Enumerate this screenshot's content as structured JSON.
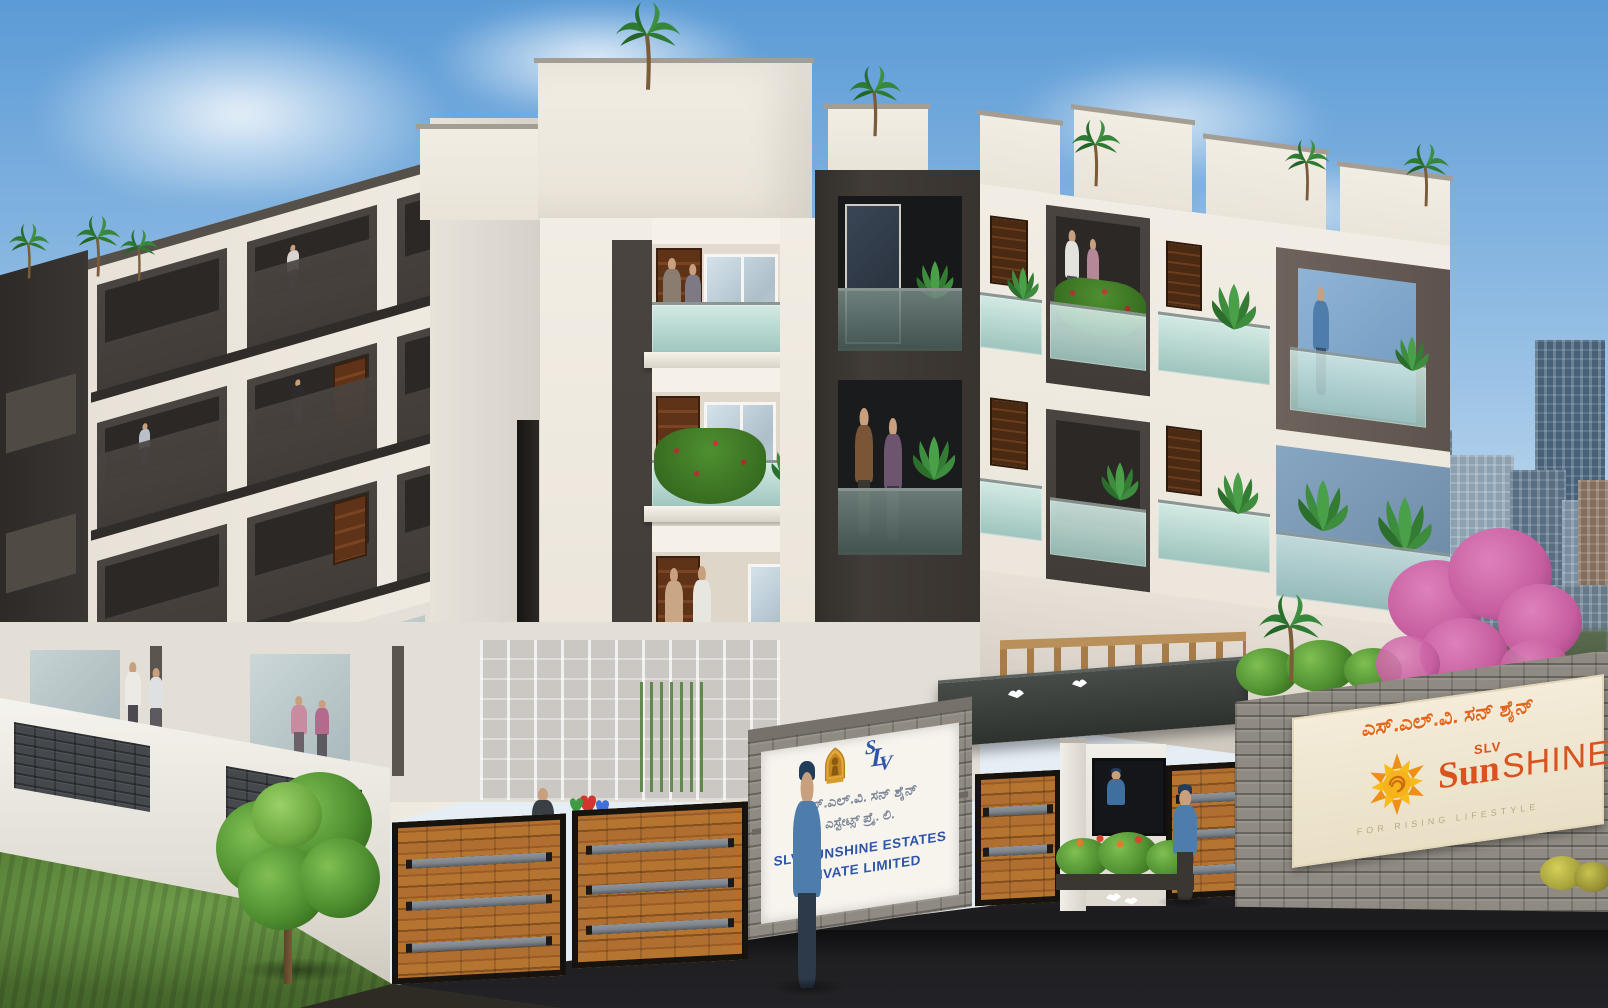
{
  "scene": {
    "title": "SLV Sunshine Estates apartment complex — exterior elevation render",
    "setting": "Four-storey cream and charcoal residential building with glass balconies, landscaped compound wall, wooden entrance gates, security guards and a city skyline backdrop"
  },
  "entrance_sign": {
    "monogram_letters": [
      "S",
      "L",
      "V"
    ],
    "kannada_line1": "ಎಸ್.ಎಲ್.ವಿ. ಸನ್ ಶೈನ್",
    "kannada_line2": "ಎಸ್ಟೇಟ್ಸ್ ಪ್ರೈ. ಲಿ.",
    "english_line1": "SLV SUNSHINE ESTATES",
    "english_line2": "PRIVATE LIMITED"
  },
  "brand_sign": {
    "kannada": "ಎಸ್.ಎಲ್.ವಿ. ಸನ್ ಶೈನ್",
    "brand_slv": "SLV",
    "brand_sun": "Sun",
    "brand_shine": "SHINE",
    "tagline": "FOR RISING LIFESTYLE"
  },
  "palette": {
    "sky-top": "#5b9bd6",
    "sky-mid": "#9cc3e6",
    "sky-low": "#d9e8f3",
    "facade": "#f2ede4",
    "facade-shade": "#ddd7cc",
    "cap": "#a49d93",
    "charcoal": "#413c38",
    "charcoal-deep": "#2b2825",
    "glass": "#bcdcd6",
    "wood-door": "#5f3318",
    "gate-wood": "#b06f30",
    "gate-wood-dark": "#84501f",
    "steel": "#7d848b",
    "frame-black": "#17130f",
    "stone": "#8f8a82",
    "slate": "#45494e",
    "asphalt": "#212025",
    "grass": "#567f36",
    "foliage": "#4f8f30",
    "foliage-light": "#7fbf52",
    "foliage-deep": "#356b1f",
    "pink": "#c75e9f",
    "pink-light": "#dd82bb",
    "skyline": "#7f95a8",
    "skyline-light": "#9fb3c1",
    "skyline-dark": "#4c667e",
    "sign-blue": "#2e55a8",
    "kannada-gray": "#7d8694",
    "orange": "#e2661c",
    "brand-red": "#d9531e",
    "cream": "#f4ecd9",
    "gold": "#e0a23a",
    "tagline-tan": "#b9a98c",
    "uniform-blue": "#4f7dab",
    "navy": "#223c5c",
    "skin": "#c9a07d"
  }
}
